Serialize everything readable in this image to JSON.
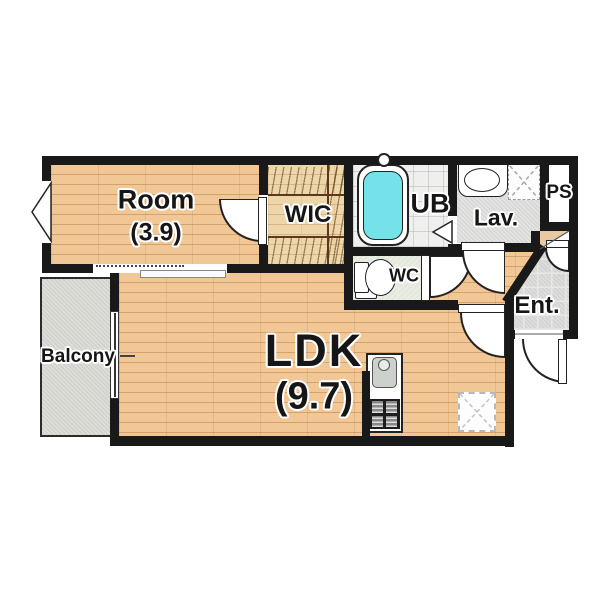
{
  "floorplan": {
    "rooms": {
      "room": {
        "label": "Room",
        "size": "(3.9)"
      },
      "wic": {
        "label": "WIC"
      },
      "ub": {
        "label": "UB"
      },
      "lav": {
        "label": "Lav."
      },
      "ps": {
        "label": "PS"
      },
      "wc": {
        "label": "WC"
      },
      "ent": {
        "label": "Ent."
      },
      "ldk": {
        "label": "LDK",
        "size": "(9.7)"
      },
      "balcony": {
        "label": "Balcony"
      }
    },
    "colors": {
      "wall": "#191919",
      "wood_floor": "#f2c796",
      "wic_floor": "#eed6ab",
      "bathtub_water": "#74e2e8",
      "balcony_floor": "#d3d3cd",
      "lav_floor": "#d8d8d6",
      "wc_floor": "#e4e9de",
      "ub_floor": "#eff0ee",
      "entrance_tile": "#d4d4d2"
    }
  }
}
